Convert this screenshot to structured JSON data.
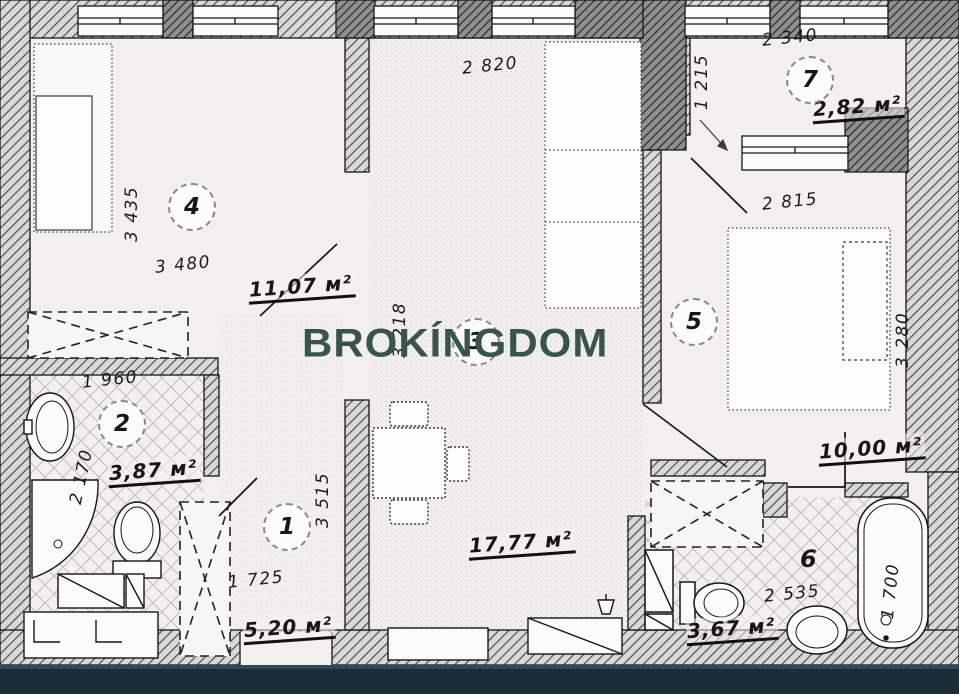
{
  "watermark": {
    "text": "BROKÍNGDOM",
    "color": "#3a544d"
  },
  "rooms": {
    "r1": {
      "number": "1",
      "area": "5,20 м²",
      "dim_w": "1 725",
      "dim_h": "3 515"
    },
    "r2": {
      "number": "2",
      "area": "3,87 м²",
      "dim_w": "1 960",
      "dim_h": "2 170"
    },
    "r3": {
      "number": "3",
      "area": "17,77 м²",
      "dim_w": "2 820",
      "dim_h": "3 218"
    },
    "r4": {
      "number": "4",
      "area": "11,07 м²",
      "dim_w": "3 480",
      "dim_h": "3 435"
    },
    "r5": {
      "number": "5",
      "area": "10,00 м²",
      "dim_w": "2 815",
      "dim_h": "3 280"
    },
    "r6": {
      "number": "6",
      "area": "3,67 м²",
      "dim_w": "2 535",
      "dim_h": "1 700"
    },
    "r7": {
      "number": "7",
      "area": "2,82 м²",
      "dim_w": "2 340",
      "dim_h": "1 215"
    }
  },
  "colors": {
    "paper": "#f1f0ed",
    "ink": "#161616",
    "footer": "#1b2d38",
    "watermark": "#3a544d"
  }
}
